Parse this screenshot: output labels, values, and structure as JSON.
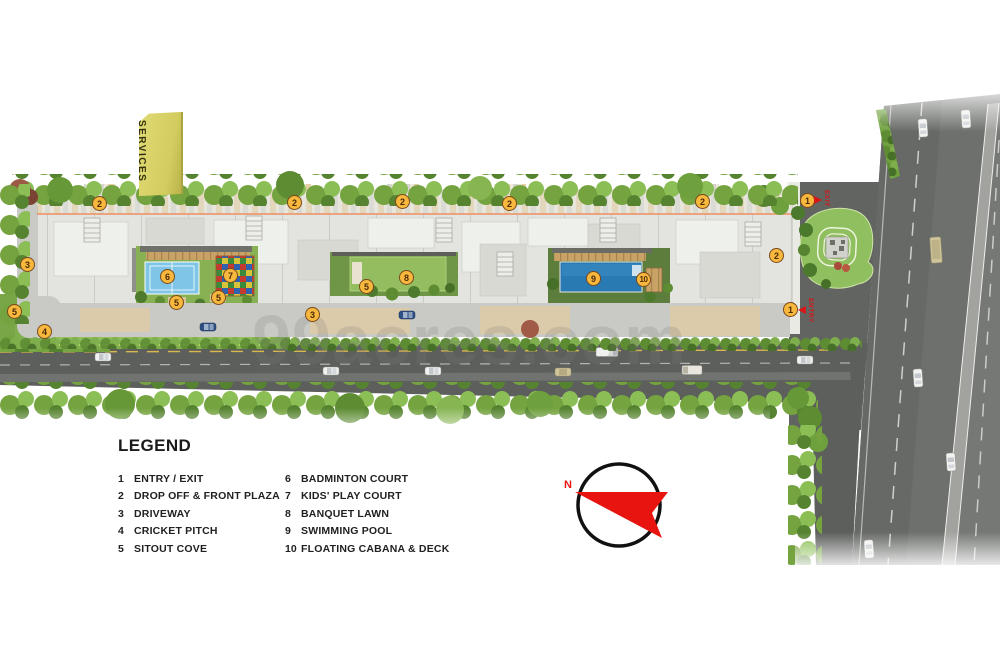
{
  "watermark": {
    "text": "99acres.com"
  },
  "plan": {
    "services_label": "SERVICES",
    "entry_label": "ENTRY",
    "exit_label": "EXIT",
    "markers": [
      {
        "n": "2",
        "x": 100,
        "y": 204
      },
      {
        "n": "2",
        "x": 295,
        "y": 203
      },
      {
        "n": "2",
        "x": 403,
        "y": 202
      },
      {
        "n": "2",
        "x": 510,
        "y": 204
      },
      {
        "n": "2",
        "x": 703,
        "y": 202
      },
      {
        "n": "2",
        "x": 777,
        "y": 256
      },
      {
        "n": "1",
        "x": 808,
        "y": 201
      },
      {
        "n": "1",
        "x": 791,
        "y": 310
      },
      {
        "n": "3",
        "x": 28,
        "y": 265
      },
      {
        "n": "3",
        "x": 313,
        "y": 315
      },
      {
        "n": "4",
        "x": 45,
        "y": 332
      },
      {
        "n": "5",
        "x": 15,
        "y": 312
      },
      {
        "n": "5",
        "x": 177,
        "y": 303
      },
      {
        "n": "5",
        "x": 219,
        "y": 298
      },
      {
        "n": "5",
        "x": 367,
        "y": 287
      },
      {
        "n": "6",
        "x": 168,
        "y": 277
      },
      {
        "n": "7",
        "x": 231,
        "y": 276
      },
      {
        "n": "8",
        "x": 407,
        "y": 278
      },
      {
        "n": "9",
        "x": 594,
        "y": 279
      },
      {
        "n": "10",
        "x": 644,
        "y": 280
      }
    ]
  },
  "compass": {
    "north_label": "N"
  },
  "legend": {
    "title": "LEGEND",
    "items": [
      {
        "num": "1",
        "label": "ENTRY / EXIT"
      },
      {
        "num": "2",
        "label": "DROP OFF & FRONT PLAZA"
      },
      {
        "num": "3",
        "label": "DRIVEWAY"
      },
      {
        "num": "4",
        "label": "CRICKET PITCH"
      },
      {
        "num": "5",
        "label": "SITOUT COVE"
      },
      {
        "num": "6",
        "label": "BADMINTON COURT"
      },
      {
        "num": "7",
        "label": "KIDS' PLAY COURT"
      },
      {
        "num": "8",
        "label": "BANQUET LAWN"
      },
      {
        "num": "9",
        "label": "SWIMMING POOL"
      },
      {
        "num": "10",
        "label": "FLOATING CABANA & DECK"
      }
    ]
  },
  "colors": {
    "marker_bg": "#f7b83d",
    "marker_border": "#7a481c",
    "accent_red": "#d81616",
    "salmon_path": "#ec9a72",
    "pool_blue": "#2979b2",
    "court_blue": "#7ec5e8",
    "lawn_green": "#87b152",
    "road_gray": "#5d5f5d"
  }
}
